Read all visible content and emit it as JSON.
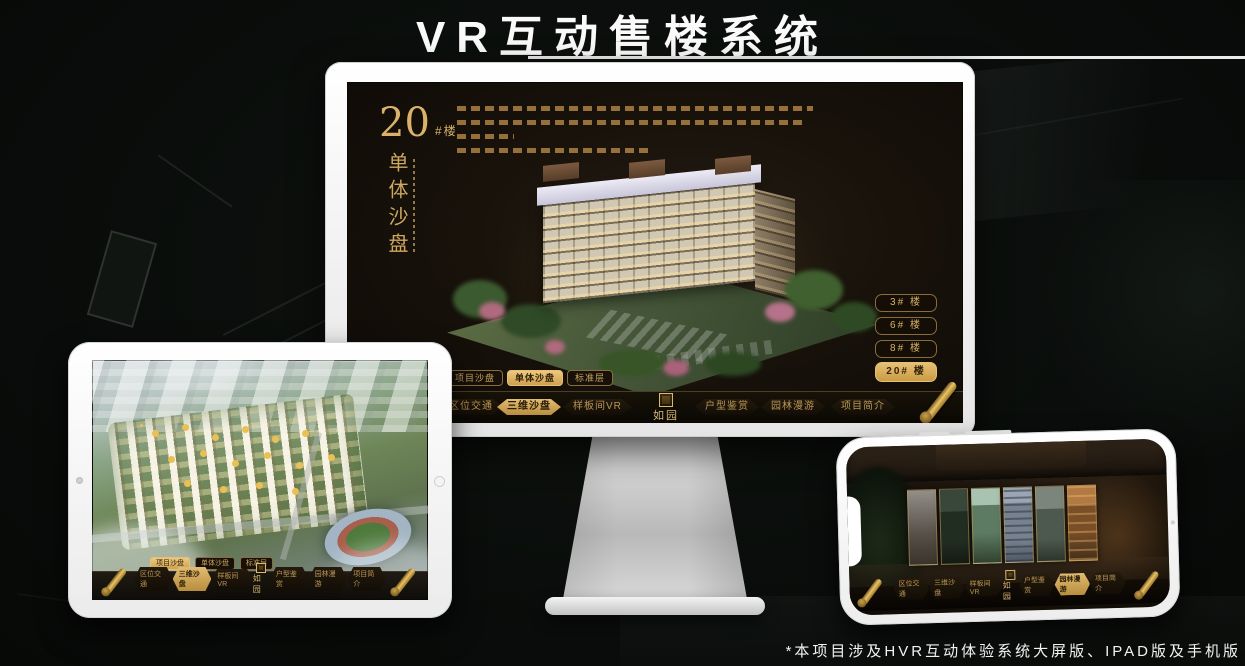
{
  "page": {
    "title": "VR互动售楼系统",
    "footnote": "*本项目涉及HVR互动体验系统大屏版、IPAD版及手机版"
  },
  "colors": {
    "gold": "#c9a45e",
    "gold_active": "#d9b36a",
    "panel_dark": "#161007",
    "background": "#0a0d0b"
  },
  "monitor": {
    "block_number": "20",
    "block_unit": "#楼",
    "vertical_title": "单体沙盘",
    "floor_buttons": [
      {
        "label": "3# 楼",
        "active": false
      },
      {
        "label": "6# 楼",
        "active": false
      },
      {
        "label": "8# 楼",
        "active": false
      },
      {
        "label": "20# 楼",
        "active": true
      }
    ],
    "tabs": [
      {
        "label": "项目沙盘",
        "active": false
      },
      {
        "label": "单体沙盘",
        "active": true
      },
      {
        "label": "标准层",
        "active": false
      }
    ],
    "nav_items": [
      {
        "label": "区位交通",
        "active": false
      },
      {
        "label": "三维沙盘",
        "active": true
      },
      {
        "label": "样板间VR",
        "active": false
      },
      {
        "label": "户型鉴赏",
        "active": false
      },
      {
        "label": "园林漫游",
        "active": false
      },
      {
        "label": "项目简介",
        "active": false
      }
    ],
    "logo": "如园"
  },
  "ipad": {
    "tabs": [
      {
        "label": "项目沙盘",
        "active": true
      },
      {
        "label": "单体沙盘",
        "active": false
      },
      {
        "label": "标准层",
        "active": false
      }
    ],
    "nav_items": [
      {
        "label": "区位交通",
        "active": false
      },
      {
        "label": "三维沙盘",
        "active": true
      },
      {
        "label": "样板间VR",
        "active": false
      },
      {
        "label": "户型鉴赏",
        "active": false
      },
      {
        "label": "园林漫游",
        "active": false
      },
      {
        "label": "项目简介",
        "active": false
      }
    ],
    "logo": "如园"
  },
  "phone": {
    "nav_items": [
      {
        "label": "区位交通",
        "active": false
      },
      {
        "label": "三维沙盘",
        "active": false
      },
      {
        "label": "样板间VR",
        "active": false
      },
      {
        "label": "户型鉴赏",
        "active": false
      },
      {
        "label": "园林漫游",
        "active": true
      },
      {
        "label": "项目简介",
        "active": false
      }
    ],
    "logo": "如园"
  }
}
